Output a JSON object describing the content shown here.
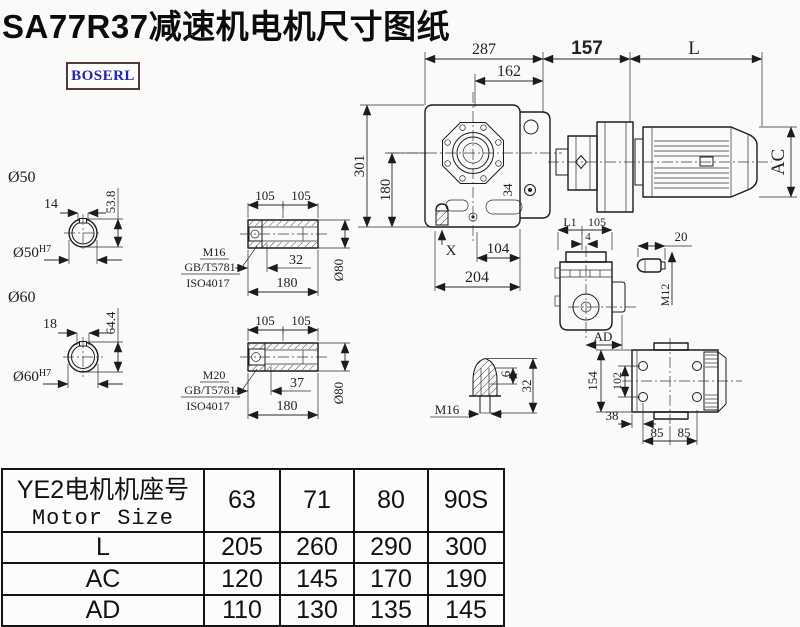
{
  "title": "SA77R37减速机电机尺寸图纸",
  "logo": "BOSERL",
  "main_view": {
    "dim_287": "287",
    "dim_162": "162",
    "dim_157": "157",
    "dim_L": "L",
    "dim_301": "301",
    "dim_180": "180",
    "dim_AC": "AC",
    "dim_34": "34",
    "dim_X": "X",
    "dim_104": "104",
    "dim_204": "204"
  },
  "shaft_50": {
    "label": "Ø50",
    "keyway": "14",
    "height": "53.8",
    "bore": "Ø50",
    "tol": "H7"
  },
  "shaft_60": {
    "label": "Ø60",
    "keyway": "18",
    "height": "64.4",
    "bore": "Ø60",
    "tol": "H7"
  },
  "bushing_m16": {
    "dim_105a": "105",
    "dim_105b": "105",
    "dim_32": "32",
    "dim_180": "180",
    "dim_d80": "Ø80",
    "bolt": "M16",
    "std1": "GB/T5781",
    "std2": "ISO4017"
  },
  "bushing_m20": {
    "dim_105a": "105",
    "dim_105b": "105",
    "dim_37": "37",
    "dim_180": "180",
    "dim_d80": "Ø80",
    "bolt": "M20",
    "std1": "GB/T5781",
    "std2": "ISO4017"
  },
  "end_plug": {
    "dim_6": "6",
    "dim_32": "32",
    "bolt": "M16"
  },
  "side_view": {
    "dim_L1": "L1",
    "dim_105": "105",
    "dim_4": "4",
    "dim_AD": "AD"
  },
  "pin": {
    "dim_20": "20",
    "thread": "M12"
  },
  "top_view": {
    "dim_154": "154",
    "dim_102": "102",
    "dim_38": "38",
    "dim_85a": "85",
    "dim_85b": "85"
  },
  "table": {
    "header_cn": "YE2电机机座号",
    "header_en": "Motor Size",
    "sizes": [
      "63",
      "71",
      "80",
      "90S"
    ],
    "rows": [
      {
        "label": "L",
        "values": [
          "205",
          "260",
          "290",
          "300"
        ]
      },
      {
        "label": "AC",
        "values": [
          "120",
          "145",
          "170",
          "190"
        ]
      },
      {
        "label": "AD",
        "values": [
          "110",
          "130",
          "135",
          "145"
        ]
      }
    ]
  }
}
